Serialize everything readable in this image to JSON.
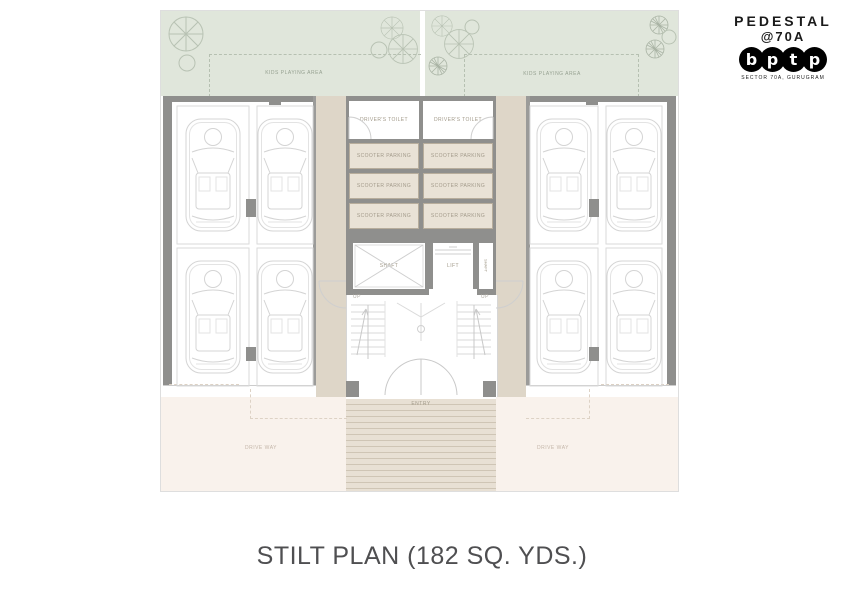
{
  "logo": {
    "name": "PEDESTAL",
    "sub": "@70A",
    "letters": [
      "b",
      "p",
      "t",
      "p"
    ],
    "tagline": "SECTOR 70A, GURUGRAM"
  },
  "plan": {
    "kids_left": "KIDS PLAYING AREA",
    "kids_right": "KIDS PLAYING AREA",
    "toilet_left": "DRIVER'S TOILET",
    "toilet_right": "DRIVER'S TOILET",
    "scooter": "SCOOTER PARKING",
    "shaft": "SHAFT",
    "lift": "LIFT",
    "shaft_side": "SHAFT",
    "up": "UP",
    "entry": "ENTRY",
    "driveway_left": "DRIVE WAY",
    "driveway_right": "DRIVE WAY"
  },
  "caption": "STILT PLAN (182 SQ. YDS.)",
  "colors": {
    "green_area": "#e0e6db",
    "corridor_beige": "#ded6c8",
    "scooter_cell": "#e9e2d6",
    "wall_gray": "#8f8f8d",
    "driveway_pink": "#f9f2ec",
    "steps_beige": "#e8e0d4",
    "line_gray": "#d4d4d4",
    "tree_green": "#b8c2b3"
  }
}
